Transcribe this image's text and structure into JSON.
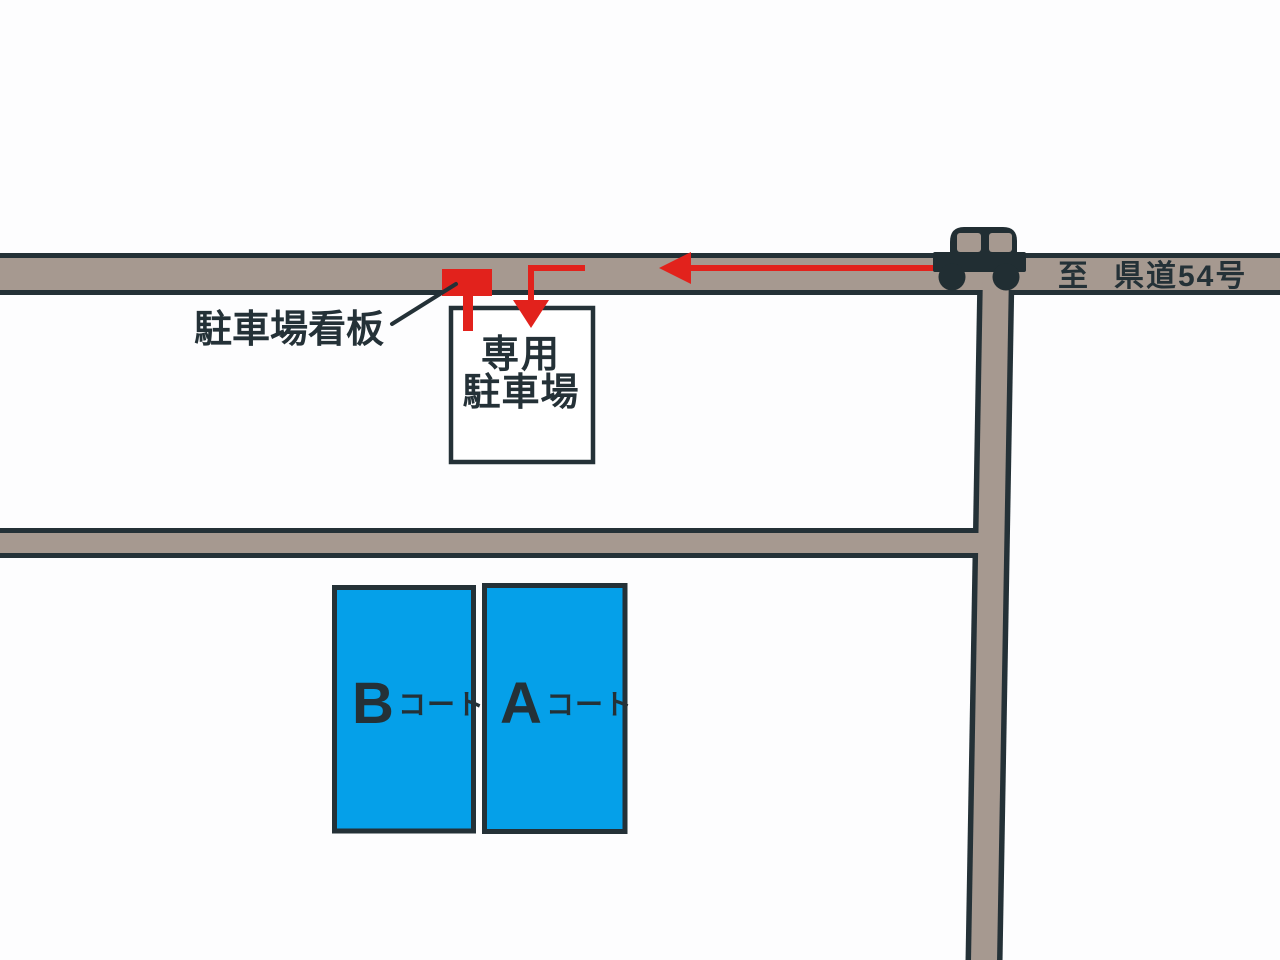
{
  "map": {
    "colors": {
      "background": "#fdfdfe",
      "road_fill": "#a69990",
      "road_outline": "#243137",
      "route_red": "#e2221c",
      "court_blue": "#05a0e9",
      "car_body": "#212e33",
      "text_dark": "#243137",
      "parking_box_fill": "#ffffff"
    },
    "destination": {
      "prefix": "至",
      "road_name": "県道54号"
    },
    "parking_sign": {
      "label": "駐車場看板"
    },
    "parking_lot": {
      "line1": "専用",
      "line2": "駐車場"
    },
    "courts": [
      {
        "letter": "B",
        "suffix": "コート"
      },
      {
        "letter": "A",
        "suffix": "コート"
      }
    ],
    "icons": {
      "car": "car-side-silhouette",
      "route_arrow_west": "left-arrow-head",
      "route_arrow_south": "down-arrow-head",
      "parking_sign_marker": "red-signboard"
    }
  }
}
